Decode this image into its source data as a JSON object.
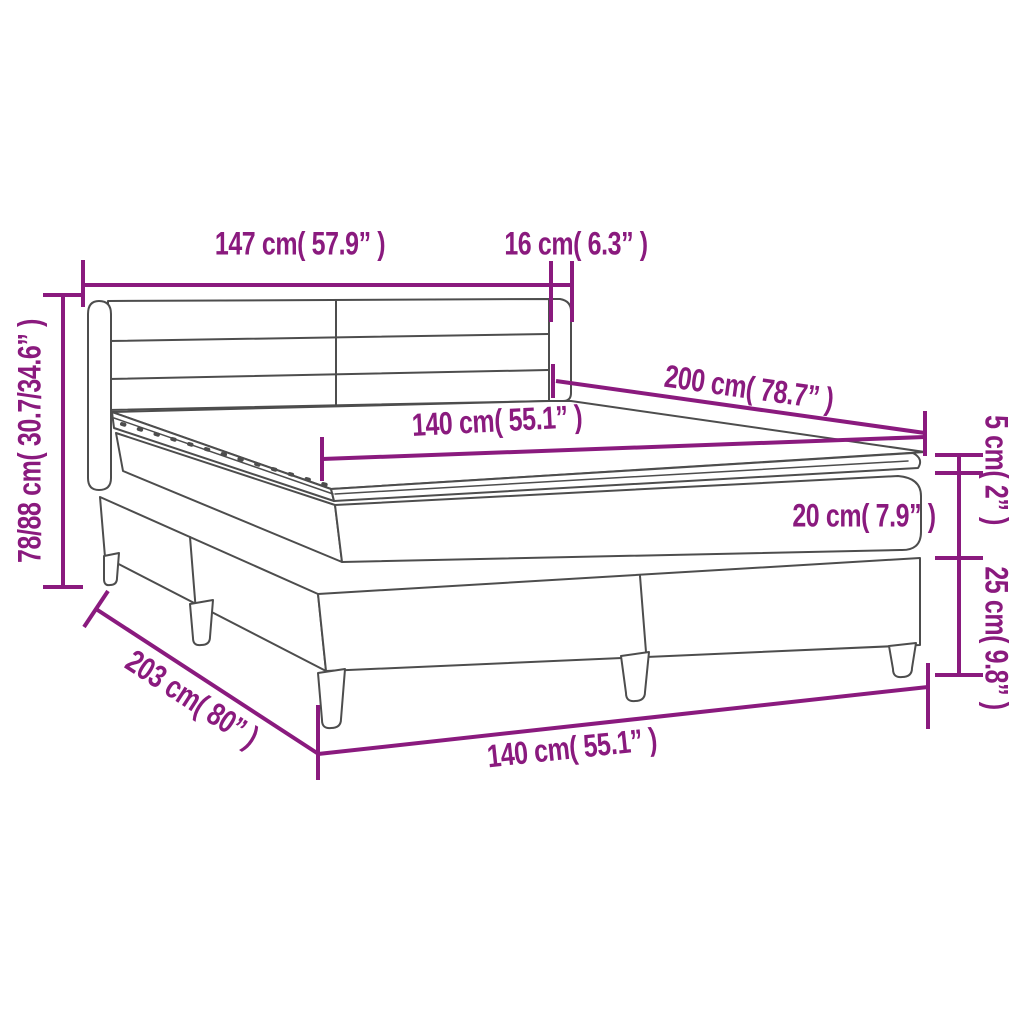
{
  "diagram": {
    "background_color": "#ffffff",
    "accent_color": "#8a1a7e",
    "line_color": "#4d4d4d",
    "labels": {
      "headboard_width": "147 cm( 57.9” )",
      "headboard_wing_depth": "16 cm( 6.3” )",
      "height_range": "78/88 cm( 30.7/34.6” )",
      "mattress_length": "200 cm( 78.7” )",
      "mattress_width": "140 cm( 55.1” )",
      "topper_thickness": "5 cm( 2” )",
      "mattress_thickness": "20 cm( 7.9” )",
      "base_height": "25 cm( 9.8” )",
      "bed_length": "203 cm( 80” )",
      "bed_width": "140 cm( 55.1” )"
    }
  }
}
